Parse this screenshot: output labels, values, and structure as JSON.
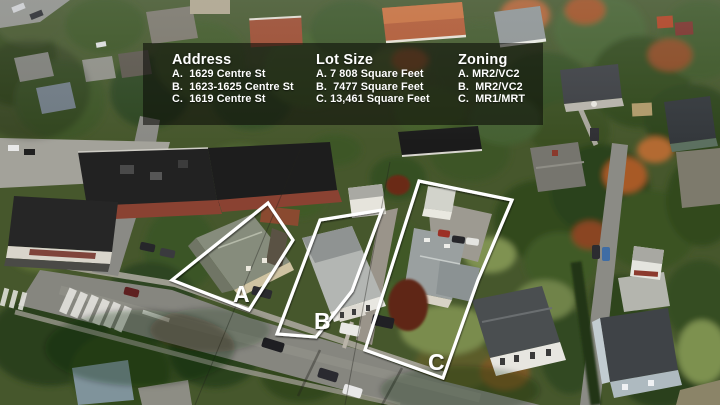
{
  "image_type": "aerial-photo-listing-overlay",
  "info_panel": {
    "columns": [
      {
        "heading": "Address",
        "items": [
          "A.  1629 Centre St",
          "B.  1623-1625 Centre St",
          "C.  1619 Centre St"
        ]
      },
      {
        "heading": "Lot Size",
        "items": [
          "A. 7 808 Square Feet",
          "B.  7477 Square Feet",
          "C. 13,461 Square Feet"
        ]
      },
      {
        "heading": "Zoning",
        "items": [
          "A. MR2/VC2",
          "B.  MR2/VC2",
          "C.  MR1/MRT"
        ]
      }
    ]
  },
  "map_labels": {
    "lot_a": "A",
    "lot_b": "B",
    "lot_c": "C"
  },
  "colors": {
    "panel_bg": "rgba(8,8,6,0.57)",
    "panel_text": "#ffffff",
    "lot_outline": "#ffffff"
  }
}
